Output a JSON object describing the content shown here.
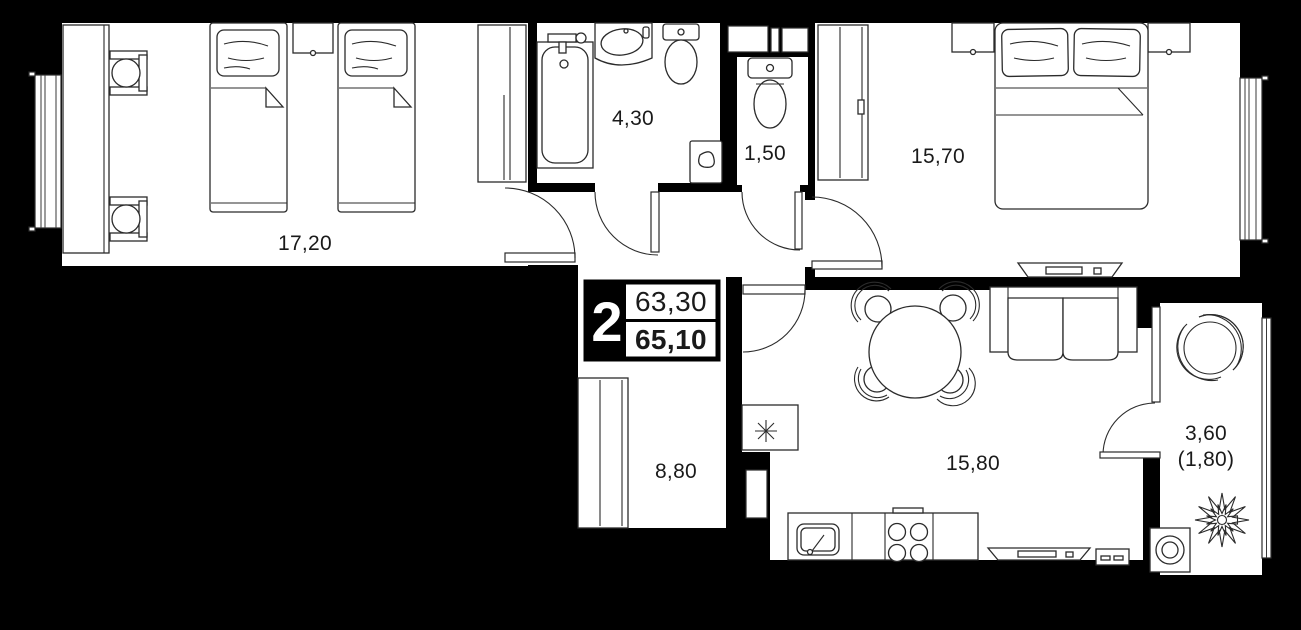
{
  "unit_card": {
    "room_count": "2",
    "area_top": "63,30",
    "area_bottom": "65,10"
  },
  "rooms": {
    "bedroom_1": {
      "area": "17,20"
    },
    "bathroom": {
      "area": "4,30"
    },
    "wc": {
      "area": "1,50"
    },
    "bedroom_2": {
      "area": "15,70"
    },
    "hallway": {
      "area": "8,80"
    },
    "kitchen_living": {
      "area": "15,80"
    },
    "balcony": {
      "area": "3,60",
      "area_reduced": "(1,80)"
    }
  },
  "colors": {
    "background": "#000000",
    "floor": "#ffffff",
    "line": "#2b2b2b"
  }
}
